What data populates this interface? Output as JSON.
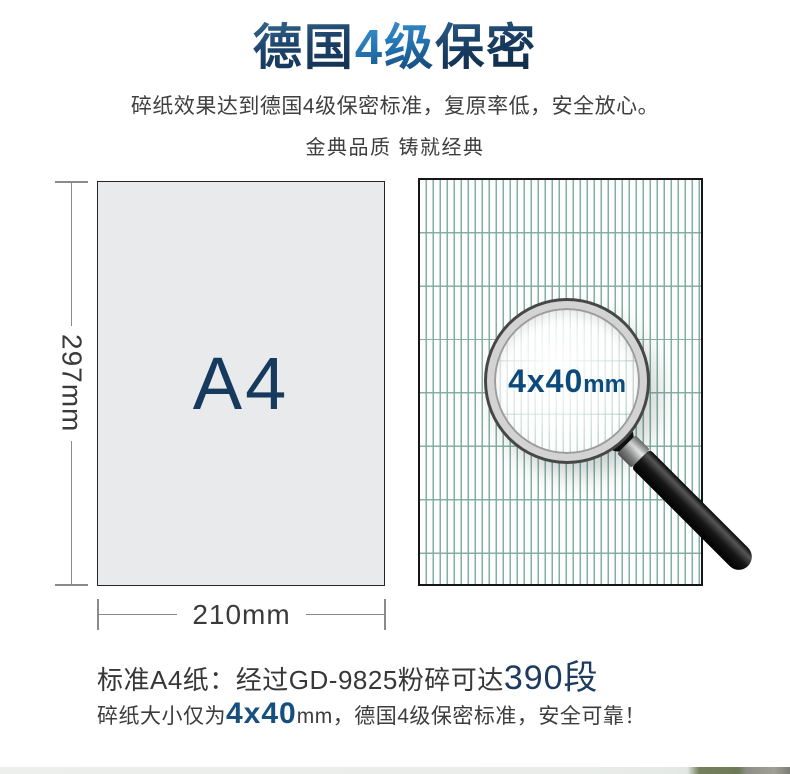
{
  "title": {
    "part1": "德国",
    "part2": "4级",
    "part3": "保密"
  },
  "subtitle": "碎纸效果达到德国4级保密标准，复原率低，安全放心。",
  "tagline": "金典品质 铸就经典",
  "paper": {
    "label": "A4",
    "height_label": "297mm",
    "width_label": "210mm"
  },
  "lens": {
    "size": "4x40",
    "unit": "mm"
  },
  "specs": {
    "line1_prefix": "标准A4纸：经过GD-9825粉碎可达",
    "line1_highlight": "390段",
    "line2_prefix": "碎纸大小仅为",
    "line2_highlight": "4x40",
    "line2_suffix": "mm，德国4级保密标准，安全可靠！"
  },
  "colors": {
    "navy": "#1d3b5e",
    "blue": "#17507f",
    "lensblue": "#0d4a7c",
    "pattern": "#6fa195",
    "pattern2": "#7aa99b",
    "graytext": "#3b3b3b",
    "dimline": "#8a8a8a",
    "paper": "#e9eaec"
  }
}
